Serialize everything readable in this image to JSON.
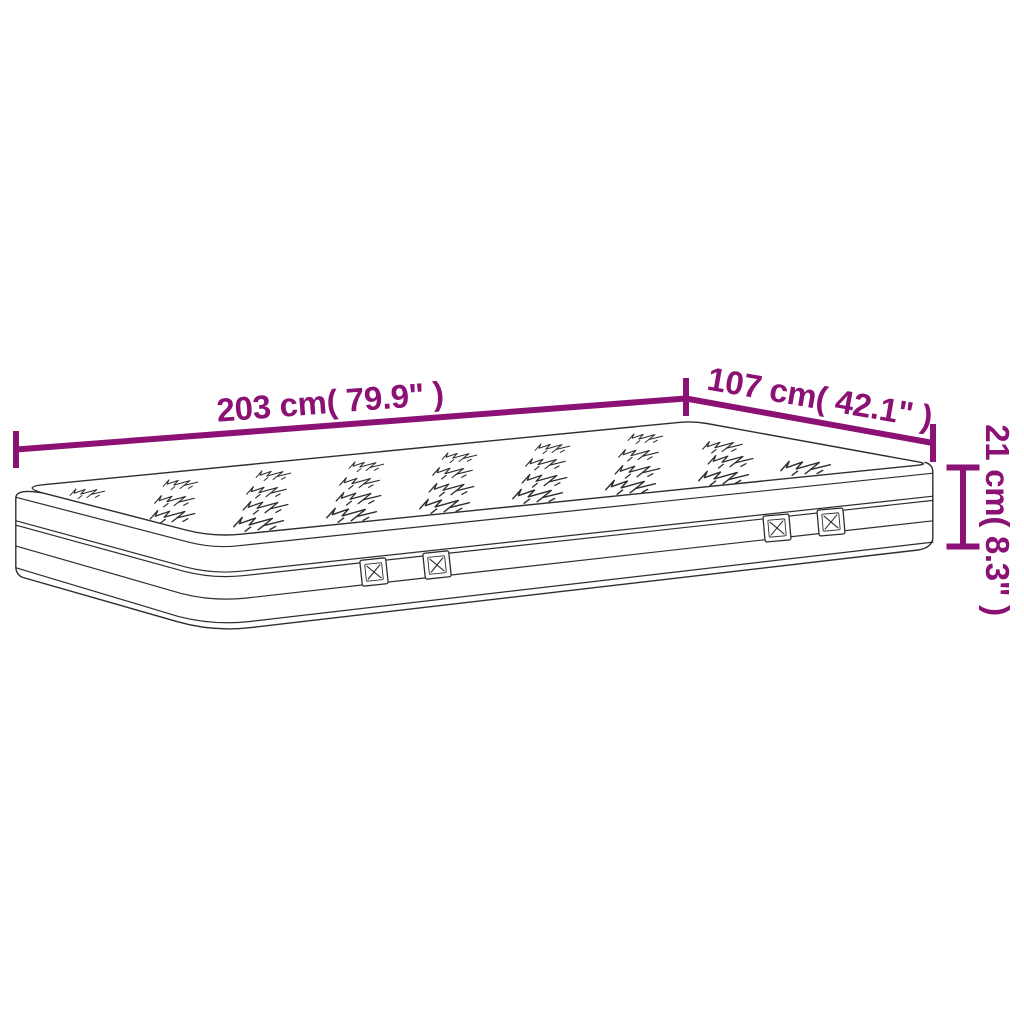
{
  "page": {
    "background": "#ffffff"
  },
  "diagram": {
    "subject": "mattress",
    "accent_color": "#8B1274",
    "outline_color": "#2e2e2e",
    "labels": {
      "length": "203 cm( 79.9\" )",
      "width": "107 cm( 42.1\" )",
      "height": "21 cm( 8.3\" )"
    }
  }
}
